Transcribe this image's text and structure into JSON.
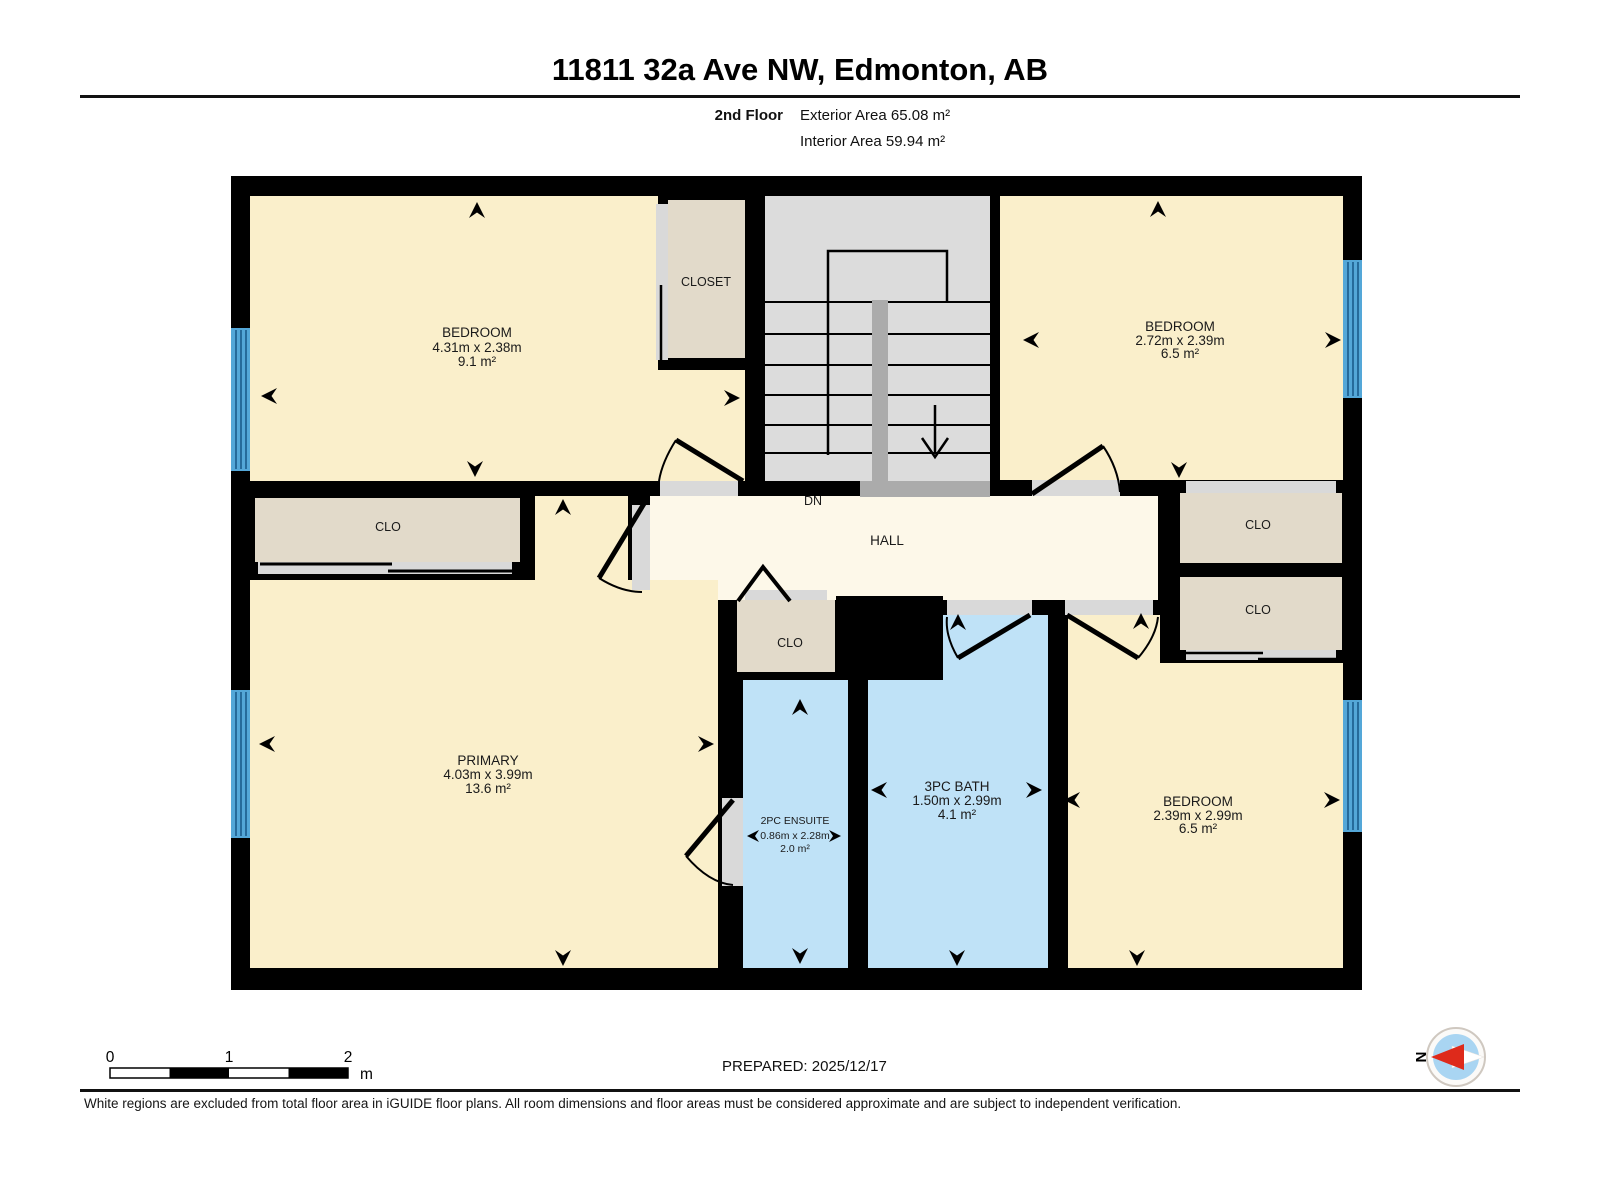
{
  "header": {
    "title": "11811 32a Ave NW, Edmonton, AB",
    "floor_label": "2nd Floor",
    "exterior_area": "Exterior Area 65.08 m²",
    "interior_area": "Interior Area 59.94 m²"
  },
  "rooms": {
    "bedroom_tl": {
      "name": "BEDROOM",
      "dims": "4.31m x 2.38m",
      "area": "9.1 m²"
    },
    "closet_top": {
      "name": "CLOSET"
    },
    "bedroom_tr": {
      "name": "BEDROOM",
      "dims": "2.72m x 2.39m",
      "area": "6.5 m²"
    },
    "clo_left": {
      "name": "CLO"
    },
    "hall": {
      "name": "HALL",
      "stairs_label": "DN"
    },
    "clo_right_upper": {
      "name": "CLO"
    },
    "clo_right_lower": {
      "name": "CLO"
    },
    "clo_center": {
      "name": "CLO"
    },
    "primary": {
      "name": "PRIMARY",
      "dims": "4.03m x 3.99m",
      "area": "13.6 m²"
    },
    "ensuite": {
      "name": "2PC ENSUITE",
      "dims": "0.86m x 2.28m",
      "area": "2.0 m²"
    },
    "bath": {
      "name": "3PC BATH",
      "dims": "1.50m x 2.99m",
      "area": "4.1 m²"
    },
    "bedroom_br": {
      "name": "BEDROOM",
      "dims": "2.39m x 2.99m",
      "area": "6.5 m²"
    }
  },
  "footer": {
    "scale": {
      "t0": "0",
      "t1": "1",
      "t2": "2",
      "unit": "m"
    },
    "prepared": "PREPARED: 2025/12/17",
    "compass_label": "N",
    "disclaimer": "White regions are excluded from total floor area in iGUIDE floor plans. All room dimensions and floor areas must be considered approximate and are subject to independent verification."
  },
  "colors": {
    "room": "#FAEFCB",
    "hall": "#FDF8E9",
    "closet": "#E2DACA",
    "bath": "#BFE2F7",
    "stairs": "#DCDCDC",
    "rail": "#ABABAB",
    "opening": "#D9D9D9",
    "window": "#54A7D8",
    "window_line": "#1C5C8C",
    "wall": "#000000",
    "compass_red": "#DE2A1B",
    "compass_blue": "#A9D5F2"
  }
}
